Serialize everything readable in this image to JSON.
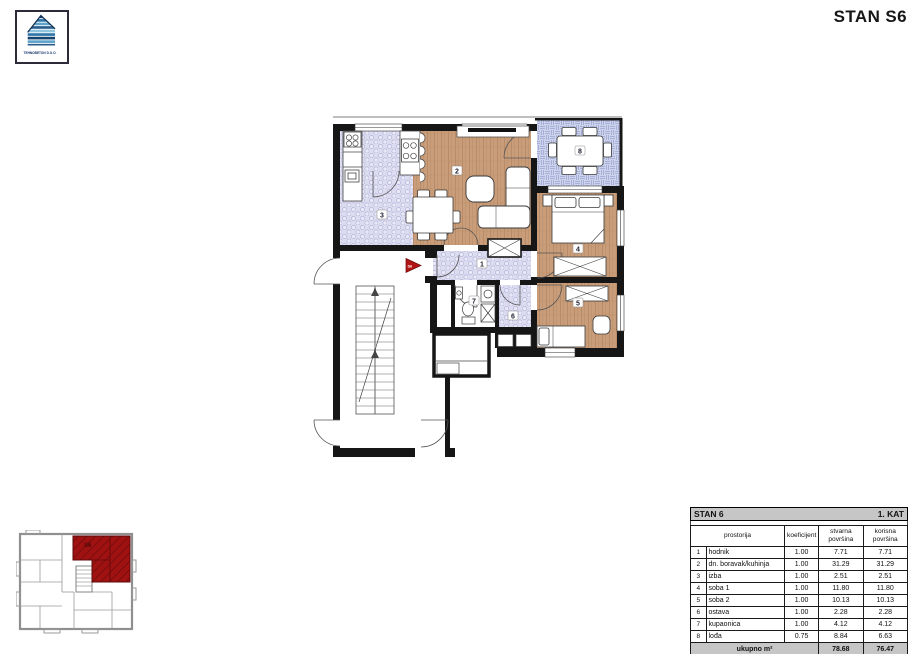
{
  "header": {
    "title": "STAN S6"
  },
  "logo": {
    "company": "TEHNOBETON D.O.O."
  },
  "plan": {
    "rooms": [
      "1",
      "2",
      "3",
      "4",
      "5",
      "6",
      "7",
      "8"
    ],
    "entrance_label": "S6"
  },
  "keyplan": {
    "unit_label": "S6"
  },
  "table": {
    "title_left": "STAN 6",
    "title_right": "1. KAT",
    "col_name": "prostorija",
    "col_coef": "koeficijent",
    "col_actual": "stvarna površina",
    "col_usable": "korisna površina",
    "rows": [
      {
        "num": "1",
        "name": "hodnik",
        "coef": "1.00",
        "actual": "7.71",
        "usable": "7.71"
      },
      {
        "num": "2",
        "name": "dn. boravak/kuhinja",
        "coef": "1.00",
        "actual": "31.29",
        "usable": "31.29"
      },
      {
        "num": "3",
        "name": "izba",
        "coef": "1.00",
        "actual": "2.51",
        "usable": "2.51"
      },
      {
        "num": "4",
        "name": "soba 1",
        "coef": "1.00",
        "actual": "11.80",
        "usable": "11.80"
      },
      {
        "num": "5",
        "name": "soba 2",
        "coef": "1.00",
        "actual": "10.13",
        "usable": "10.13"
      },
      {
        "num": "6",
        "name": "ostava",
        "coef": "1.00",
        "actual": "2.28",
        "usable": "2.28"
      },
      {
        "num": "7",
        "name": "kupaonica",
        "coef": "1.00",
        "actual": "4.12",
        "usable": "4.12"
      },
      {
        "num": "8",
        "name": "lođa",
        "coef": "0.75",
        "actual": "8.84",
        "usable": "6.63"
      }
    ],
    "total_label": "ukupno m²",
    "total_actual": "78.68",
    "total_usable": "76.47"
  },
  "colors": {
    "wall": "#161616",
    "wood_floor": "#c99d7a",
    "tile_floor": "#dcdcf0",
    "loggia_floor": "#cdd3ec",
    "highlight_red": "#a01212",
    "arrow_red": "#b31515",
    "table_header_bg": "#c6c6c6"
  }
}
